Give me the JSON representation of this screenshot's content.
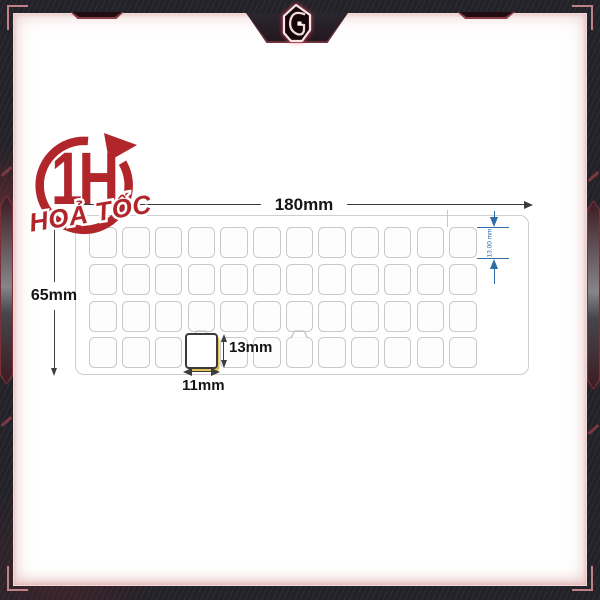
{
  "express_badge": {
    "hours_label": "1H",
    "subtitle": "HOẢ TỐC",
    "icon": "clockwise-circle-arrow-icon",
    "color": "#b0262b"
  },
  "frame": {
    "logo_icon": "g-gaming-emblem-icon"
  },
  "diagram": {
    "type": "keyboard-sticker-dimension-drawing",
    "sheet_width_label": "180mm",
    "sheet_height_label": "65mm",
    "key_height_label": "13mm",
    "key_width_label": "11mm",
    "key_row_height_note": "13.00 mm",
    "grid": {
      "rows": 4,
      "columns": 12
    },
    "highlighted_key": {
      "row": 4,
      "column": 4
    },
    "notched_keys": [
      {
        "row": 4,
        "column": 4
      },
      {
        "row": 4,
        "column": 7
      }
    ],
    "colors": {
      "key_outline": "#c9c9c9",
      "highlight_border": "#3a3a3a",
      "highlight_glow": "#dfc05a",
      "dimension_line": "#3c3c3c",
      "dimension_blue": "#2e6ca8",
      "badge_red": "#b0262b",
      "frame_dark": "#232228",
      "frame_glow_pink": "#e2b2b2"
    }
  }
}
